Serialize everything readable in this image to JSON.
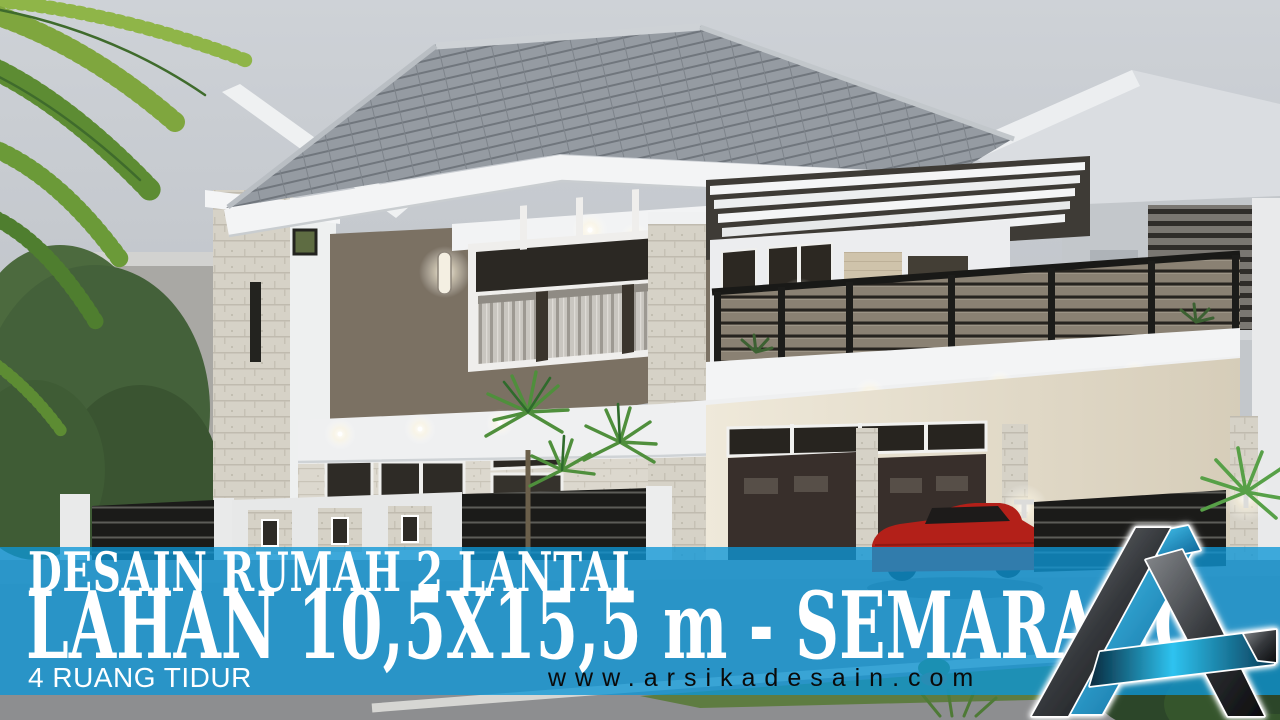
{
  "banner": {
    "line1": "DESAIN RUMAH 2 LANTAI",
    "line2": "LAHAN 10,5X15,5 m - SEMARANG",
    "line3": "4 RUANG TIDUR",
    "website": "www.arsikadesain.com"
  },
  "logo": {
    "label": "Arsika Desain letter-A monogram logo"
  },
  "scene": {
    "description": "3D exterior render of a modern two-storey house, corner view: grey hip tile roof, taupe and white walls, large curtained windows, wood-slat balcony railing, carport with dark garage doors and a red car, black slatted fence with stone piers, palm plants, grey sky"
  },
  "colors": {
    "banner_blue": "#0d96d6",
    "banner_text": "#ffffff",
    "website_text": "#0a0a0a",
    "logo_blue": "#2ec3f0",
    "logo_dark": "#1a1c1f",
    "sky_gray": "#c3c7cc",
    "roof_gray": "#8f959c",
    "wall_taupe": "#7b7163",
    "accent_red_car": "#b32019",
    "foliage_green": "#4f8f3c"
  }
}
